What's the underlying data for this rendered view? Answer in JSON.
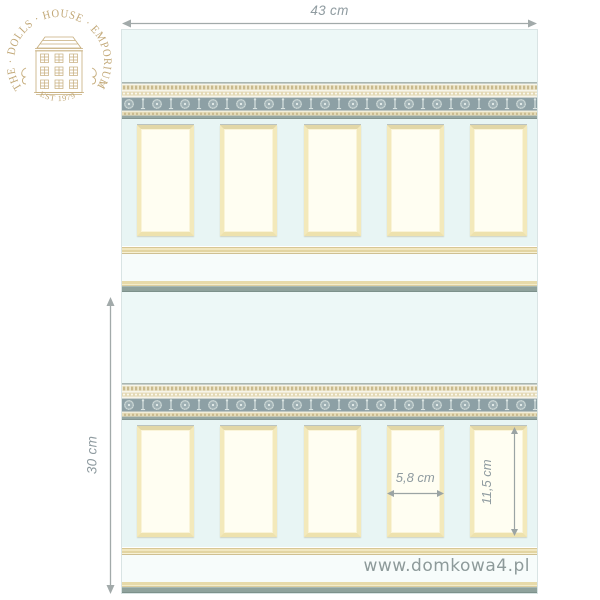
{
  "logo": {
    "arc_text": "THE · DOLLS · HOUSE · EMPORIUM",
    "established_text": "EST 1979",
    "color": "#c2a877"
  },
  "dimensions": {
    "sheet_width_label": "43 cm",
    "sheet_height_label": "30 cm",
    "panel_width_label": "5,8 cm",
    "panel_height_label": "11,5 cm"
  },
  "watermark": {
    "text": "www.domkowa4.pl"
  },
  "wallpaper": {
    "repeats_shown": 2,
    "panels_per_repeat": 5,
    "colors": {
      "wall": "#edf8f7",
      "dado": "#e8f5f4",
      "skirting": "#f7fcfb",
      "panel_fill": "#fffef2",
      "panel_frame": "#f3e9bb",
      "frieze_main": "#8da0a5",
      "frieze_trim_cream": "#e6dcb8",
      "baseboard_green": "#8fa29c",
      "baseboard_cream": "#e7daa9",
      "dimension_gray": "#9ba4a6"
    }
  }
}
